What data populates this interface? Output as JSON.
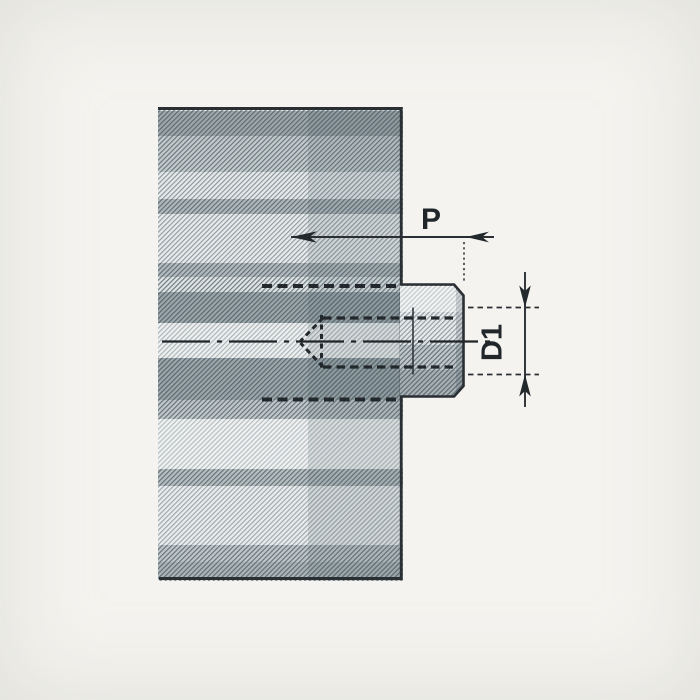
{
  "drawing": {
    "kind": "technical-section-view",
    "dimensions": {
      "p": {
        "label": "P"
      },
      "d1": {
        "label": "D1"
      }
    },
    "colors": {
      "paper": "#f4f3ef",
      "ink": "#262b2f",
      "hatch_background": "#e0e4e4",
      "hatch_stripe": "#5a6a72",
      "shadow_band": "#7e8c93"
    }
  }
}
